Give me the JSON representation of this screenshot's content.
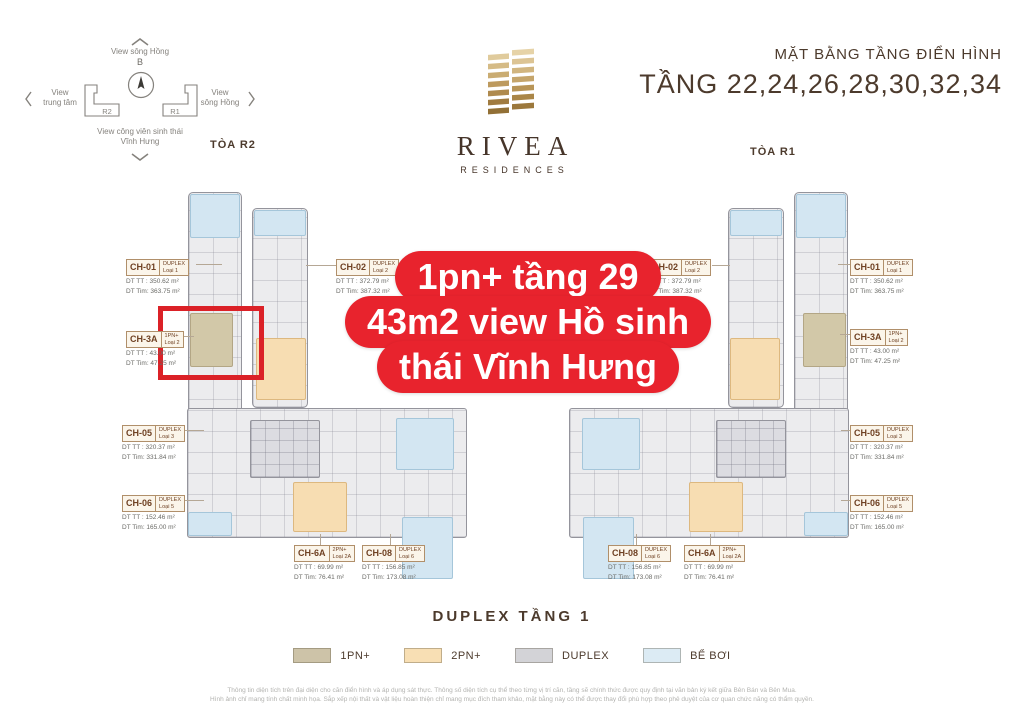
{
  "header": {
    "subtitle": "MẶT BẰNG TẦNG ĐIỂN HÌNH",
    "title": "TẦNG  22,24,26,28,30,32,34"
  },
  "logo": {
    "name": "RIVEA",
    "sub": "RESIDENCES"
  },
  "towers": {
    "left_label": "TÒA R2",
    "right_label": "TÒA R1"
  },
  "compass": {
    "north_letter": "B",
    "top_label": "View sông Hồng",
    "left_label_line1": "View",
    "left_label_line2": "trung tâm",
    "right_label_line1": "View",
    "right_label_line2": "sông Hồng",
    "bottom_label_line1": "View công viên sinh thái",
    "bottom_label_line2": "Vĩnh Hưng",
    "block_left": "R2",
    "block_right": "R1"
  },
  "banner": {
    "lines": [
      "1pn+ tầng 29",
      "43m2 view Hồ sinh",
      "thái Vĩnh Hưng"
    ]
  },
  "labels": {
    "dt_tt_prefix": "DT TT :",
    "dt_tim_prefix": "DT Tim:"
  },
  "units": [
    {
      "code": "CH-01",
      "tag_top": "DUPLEX",
      "tag_bottom": "Loại 1",
      "dt_tt": "350.62 m²",
      "dt_tim": "363.75 m²"
    },
    {
      "code": "CH-3A",
      "tag_top": "1PN+",
      "tag_bottom": "Loại 2",
      "dt_tt": "43.00 m²",
      "dt_tim": "47.25 m²"
    },
    {
      "code": "CH-05",
      "tag_top": "DUPLEX",
      "tag_bottom": "Loại 3",
      "dt_tt": "320.37 m²",
      "dt_tim": "331.84 m²"
    },
    {
      "code": "CH-06",
      "tag_top": "DUPLEX",
      "tag_bottom": "Loại 5",
      "dt_tt": "152.46 m²",
      "dt_tim": "165.00 m²"
    },
    {
      "code": "CH-02",
      "tag_top": "DUPLEX",
      "tag_bottom": "Loại 2",
      "dt_tt": "372.79 m²",
      "dt_tim": "387.32 m²"
    },
    {
      "code": "CH-6A",
      "tag_top": "2PN+",
      "tag_bottom": "Loại 2A",
      "dt_tt": "69.99 m²",
      "dt_tim": "76.41 m²"
    },
    {
      "code": "CH-08",
      "tag_top": "DUPLEX",
      "tag_bottom": "Loại 6",
      "dt_tt": "156.85 m²",
      "dt_tim": "173.08 m²"
    },
    {
      "code": "CH-02",
      "tag_top": "DUPLEX",
      "tag_bottom": "Loại 2",
      "dt_tt": "372.79 m²",
      "dt_tim": "387.32 m²"
    },
    {
      "code": "CH-08",
      "tag_top": "DUPLEX",
      "tag_bottom": "Loại 6",
      "dt_tt": "156.85 m²",
      "dt_tim": "173.08 m²"
    },
    {
      "code": "CH-6A",
      "tag_top": "2PN+",
      "tag_bottom": "Loại 2A",
      "dt_tt": "69.99 m²",
      "dt_tim": "76.41 m²"
    },
    {
      "code": "CH-01",
      "tag_top": "DUPLEX",
      "tag_bottom": "Loại 1",
      "dt_tt": "350.62 m²",
      "dt_tim": "363.75 m²"
    },
    {
      "code": "CH-3A",
      "tag_top": "1PN+",
      "tag_bottom": "Loại 2",
      "dt_tt": "43.00 m²",
      "dt_tim": "47.25 m²"
    },
    {
      "code": "CH-05",
      "tag_top": "DUPLEX",
      "tag_bottom": "Loại 3",
      "dt_tt": "320.37 m²",
      "dt_tim": "331.84 m²"
    },
    {
      "code": "CH-06",
      "tag_top": "DUPLEX",
      "tag_bottom": "Loại 5",
      "dt_tt": "152.46 m²",
      "dt_tim": "165.00 m²"
    }
  ],
  "footer": {
    "plan_title": "DUPLEX TẦNG 1",
    "legend": [
      {
        "label": "1PN+",
        "color": "#cdc3a8"
      },
      {
        "label": "2PN+",
        "color": "#f8dfb4"
      },
      {
        "label": "DUPLEX",
        "color": "#d3d3d7"
      },
      {
        "label": "BỂ BƠI",
        "color": "#dcebf4"
      }
    ],
    "disclaimer_line1": "Thông tin diện tích trên đại diện cho căn điển hình và áp dụng sát thực. Thông số diện tích cụ thể theo từng vị trí căn, tầng sẽ chính thức được quy định tại văn bản ký kết giữa Bên Bán và Bên Mua.",
    "disclaimer_line2": "Hình ảnh chỉ mang tính chất minh họa. Sắp xếp nội thất và vật liệu hoàn thiện chỉ mang mục đích tham khảo, mặt bằng này có thể được thay đổi phù hợp theo phê duyệt của cơ quan chức năng có thẩm quyền."
  },
  "colors": {
    "accent_red": "#e8232d",
    "brand_brown": "#4c3a2c",
    "gold": "#c3a369",
    "pool_blue": "#d3e6f2",
    "unit_1pn": "#d2c8a8",
    "unit_2pn": "#f7ddb2",
    "unit_duplex": "#d3d3d7"
  }
}
